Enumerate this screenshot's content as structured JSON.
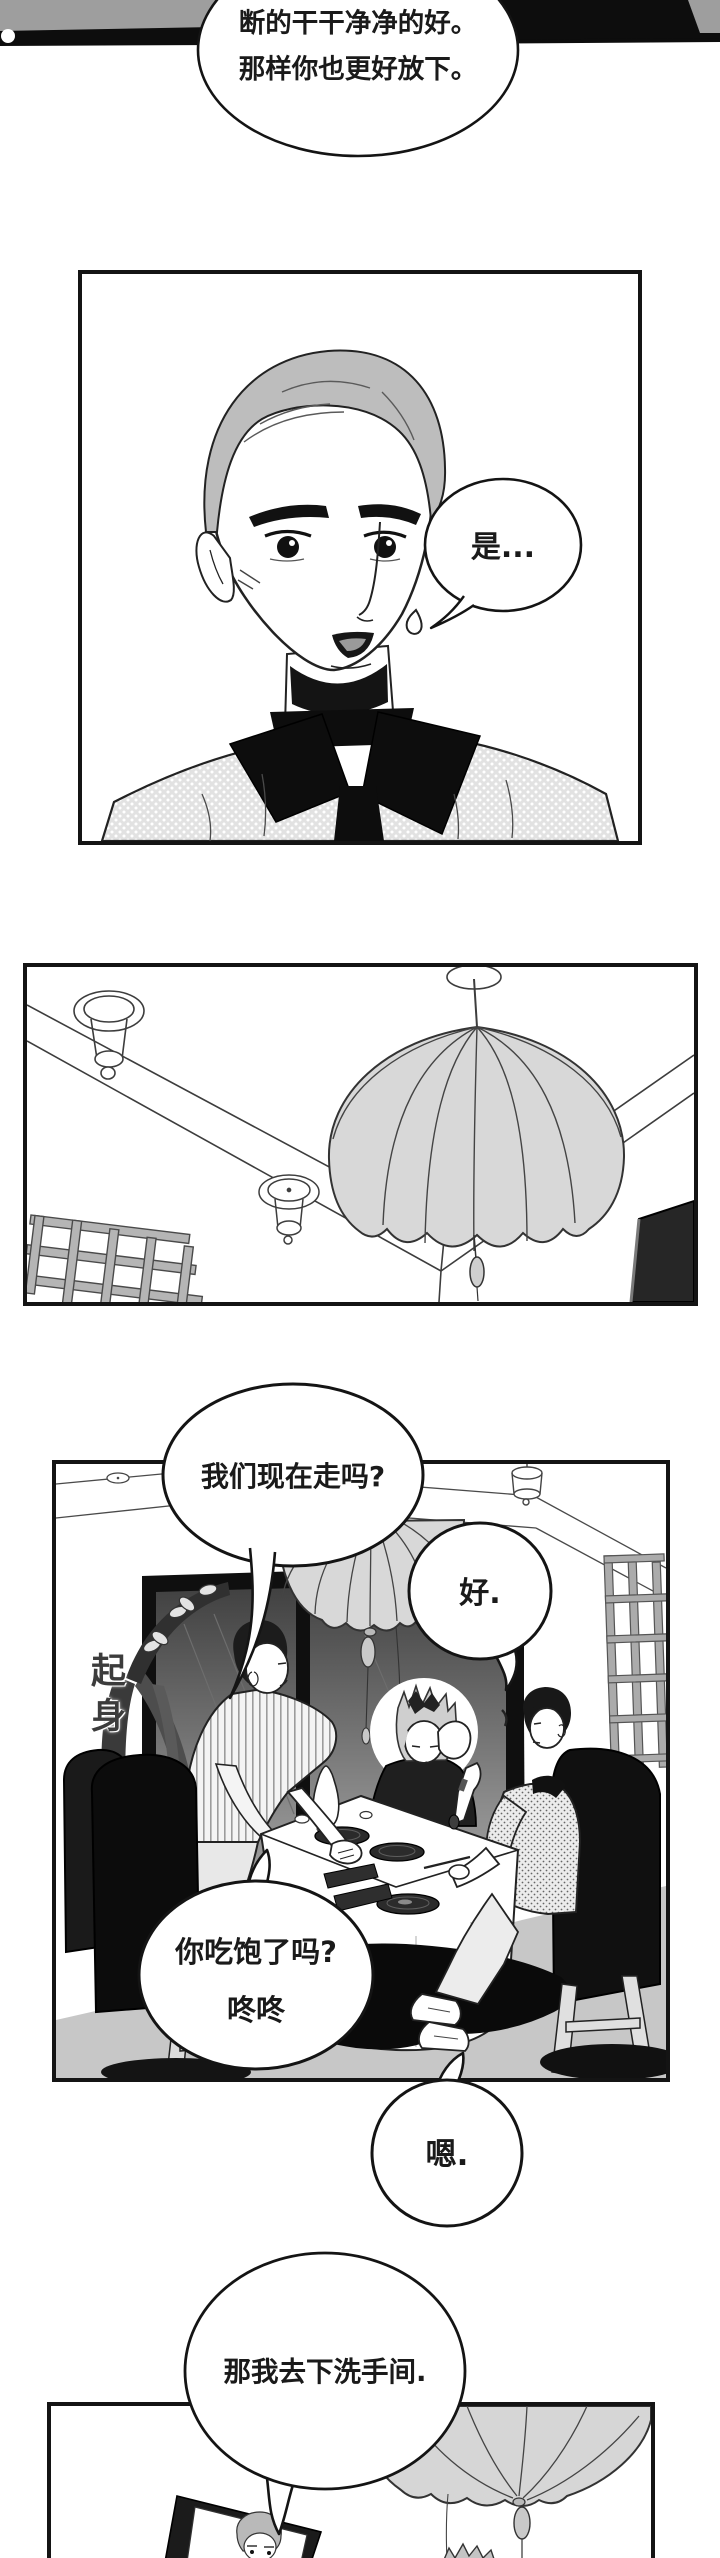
{
  "page": {
    "width": 720,
    "height": 2558
  },
  "colors": {
    "ink": "#141414",
    "paper": "#ffffff",
    "hair_gray": "#bdbdbd",
    "lantern_gray": "#d8d8d8",
    "floor_gray": "#c7c7c7",
    "strip_gray": "#9e9e9e"
  },
  "bubbles": {
    "narration_top": {
      "line1": "断的干干净净的好。",
      "line2": "那样你也更好放下。"
    },
    "shi": {
      "text": "是..."
    },
    "walk_now": {
      "text": "我们现在走吗?"
    },
    "hao": {
      "text": "好."
    },
    "full_meal": {
      "line1": "你吃饱了吗?",
      "line2": "咚咚"
    },
    "en": {
      "text": "嗯."
    },
    "restroom": {
      "text": "那我去下洗手间."
    }
  },
  "sfx": {
    "stand_up": "起身"
  }
}
